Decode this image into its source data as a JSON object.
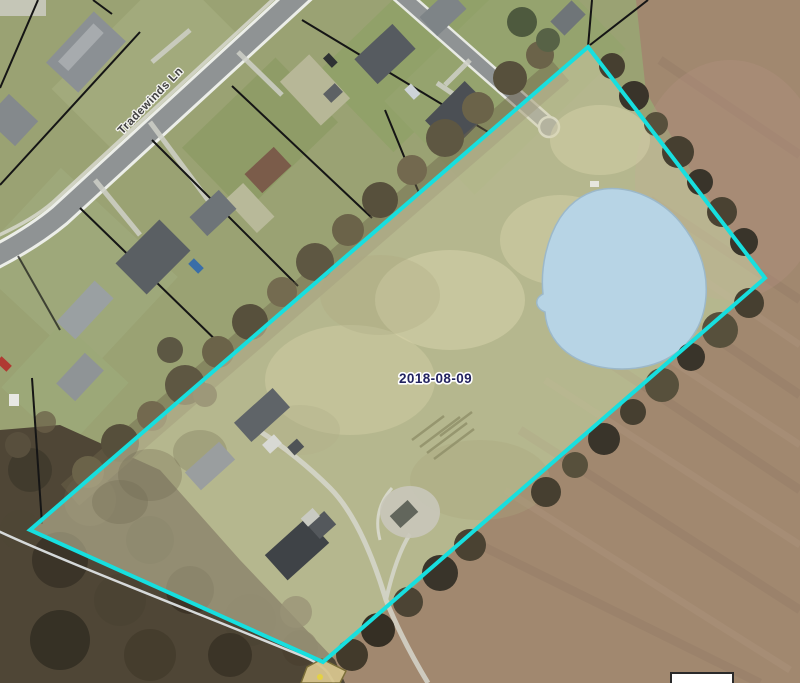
{
  "map": {
    "date_label": "2018-08-09",
    "street_label": "Tradewinds Ln"
  },
  "colors": {
    "grass": "#9aa273",
    "field": "#a1886f",
    "woods": "#4f4636",
    "road": "#8f9394",
    "stream": "#e6eaec",
    "parcel_outline": "#17dfdf",
    "parcel_fill": "#ccc9a4",
    "pond_fill": "#b7d4e5",
    "pond_stroke": "#9cb8c9",
    "date_text": "#232360",
    "street_text": "#414141"
  }
}
